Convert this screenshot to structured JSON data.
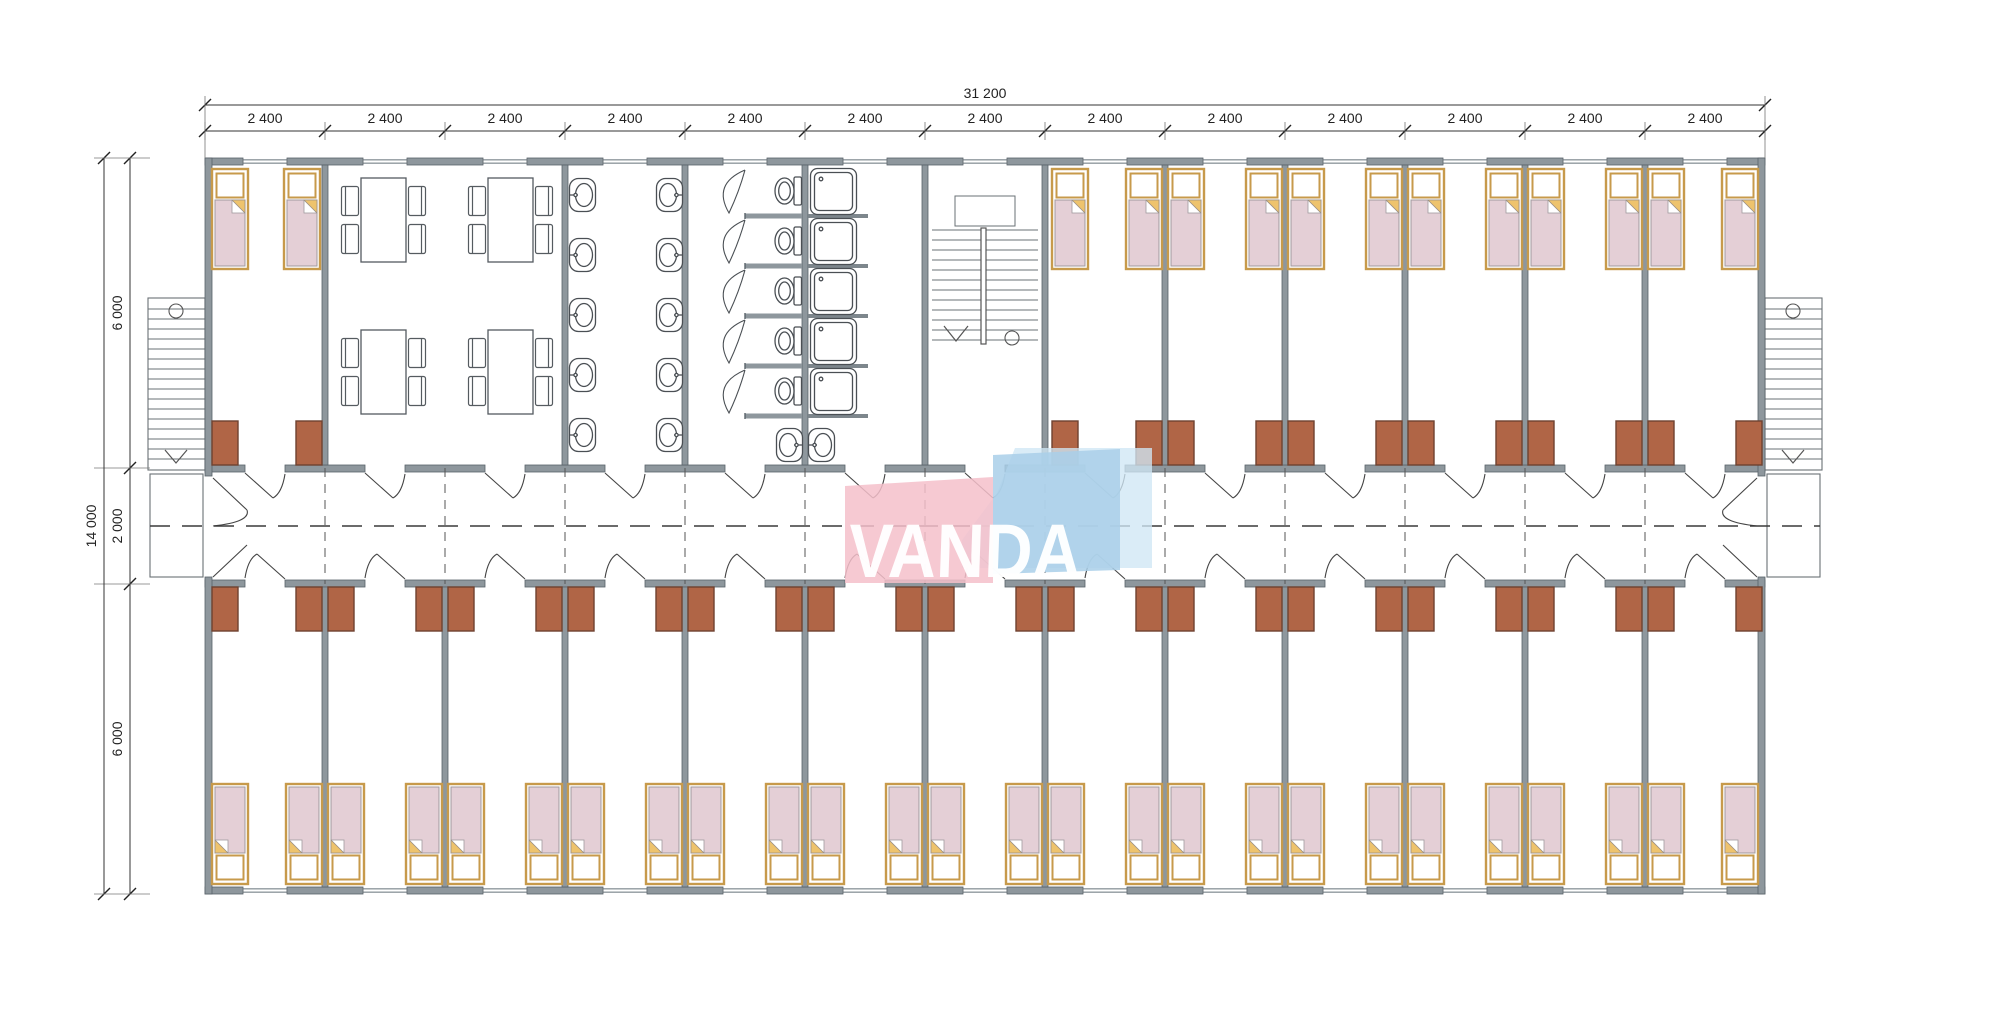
{
  "watermark": {
    "text": "VANDA",
    "pink": "#f5c0ca",
    "blue": "#a9cfe9",
    "light": "#cfe7f5"
  },
  "dimensions": {
    "top_total": "31 200",
    "top_segments": [
      "2 400",
      "2 400",
      "2 400",
      "2 400",
      "2 400",
      "2 400",
      "2 400",
      "2 400",
      "2 400",
      "2 400",
      "2 400",
      "2 400",
      "2 400"
    ],
    "left_total": "14 000",
    "left_upper": "6 000",
    "left_corridor": "2 000",
    "left_lower": "6 000"
  },
  "colors": {
    "wall_fill": "#8e979d",
    "wall_stroke": "#59626a",
    "bed_frame": "#c79a4b",
    "bed_fill": "#ffffff",
    "mattress": "#e4cfd6",
    "mattress_stroke": "#a09a9e",
    "fold_gold": "#eec36d",
    "desk_fill": "#b06546",
    "desk_stroke": "#6e4230",
    "fixture_stroke": "#4a4f54",
    "dim_line": "#333333",
    "dash_line": "#3a3a3a"
  }
}
